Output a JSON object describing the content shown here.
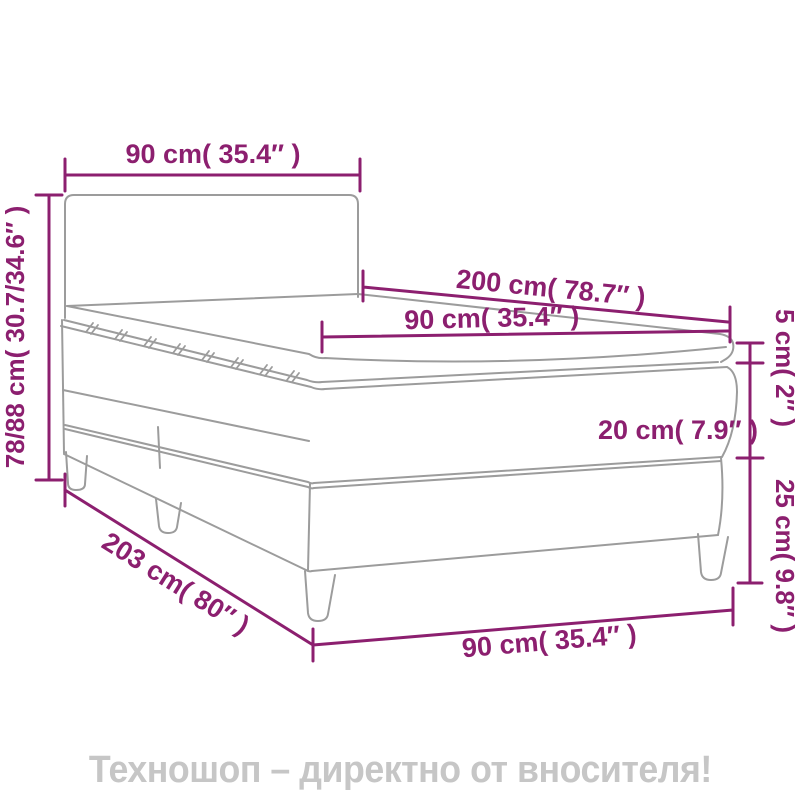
{
  "colors": {
    "dimension": "#8C1F6F",
    "drawing": "#9C9C9C",
    "footer_text": "#C6C6C6",
    "background": "#FFFFFF"
  },
  "diagram": {
    "labels": {
      "headboard_width": "90 cm( 35.4″ )",
      "total_height": "78/88 cm( 30.7/34.6″ )",
      "length": "200 cm( 78.7″ )",
      "mattress_width": "90 cm( 35.4″ )",
      "topper_height": "5 cm( 2″ )",
      "mattress_height": "20 cm( 7.9″ )",
      "leg_height": "25 cm( 9.8″ )",
      "base_length": "203 cm( 80″ )",
      "base_width": "90 cm( 35.4″ )"
    }
  },
  "footer": {
    "text": "Техношоп – директно от вносителя!"
  }
}
